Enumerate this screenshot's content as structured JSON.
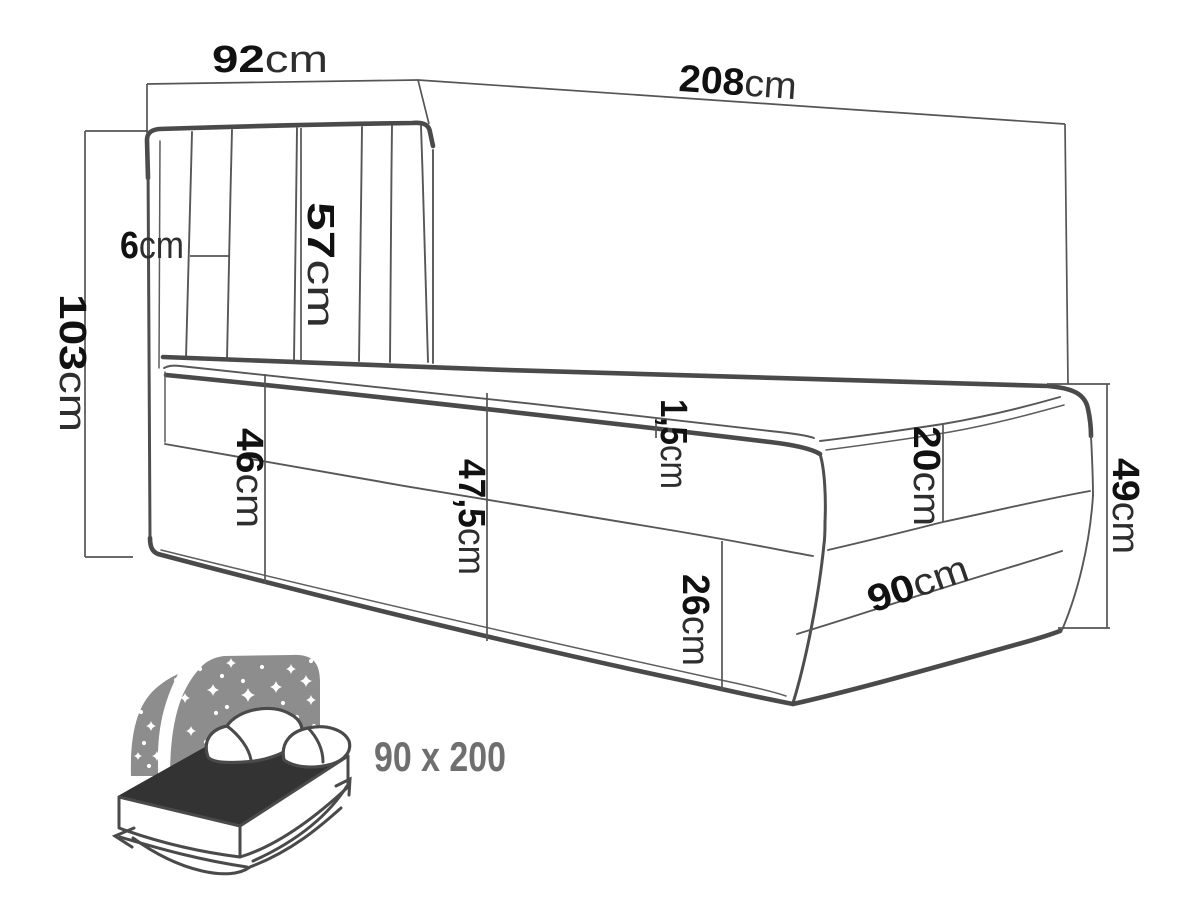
{
  "diagram": {
    "kind": "bed-dimension-diagram",
    "unit_default": "cm",
    "dimensions": {
      "headboard_width": {
        "value": "92",
        "unit": "cm"
      },
      "total_length": {
        "value": "208",
        "unit": "cm"
      },
      "total_height": {
        "value": "103",
        "unit": "cm"
      },
      "headboard_side": {
        "value": "6",
        "unit": "cm"
      },
      "headboard_panel_height": {
        "value": "57",
        "unit": "cm"
      },
      "topper_thickness": {
        "value": "1,5",
        "unit": "cm"
      },
      "height_at_head": {
        "value": "46",
        "unit": "cm"
      },
      "height_mid": {
        "value": "47,5",
        "unit": "cm"
      },
      "base_lower_height": {
        "value": "26",
        "unit": "cm"
      },
      "mattress_height": {
        "value": "20",
        "unit": "cm"
      },
      "foot_total_height": {
        "value": "49",
        "unit": "cm"
      },
      "foot_width": {
        "value": "90",
        "unit": "cm"
      }
    },
    "size_badge": {
      "label": "90 x 200"
    },
    "icon": {
      "name": "storage-bed-starry-headboard-icon"
    },
    "colors": {
      "line": "#4a4a4a",
      "dimension_text": "#1e1e1e",
      "icon_gray": "#8d8d8d",
      "icon_dark": "#333333",
      "badge_text": "#6f6f6f",
      "background": "#ffffff"
    }
  }
}
